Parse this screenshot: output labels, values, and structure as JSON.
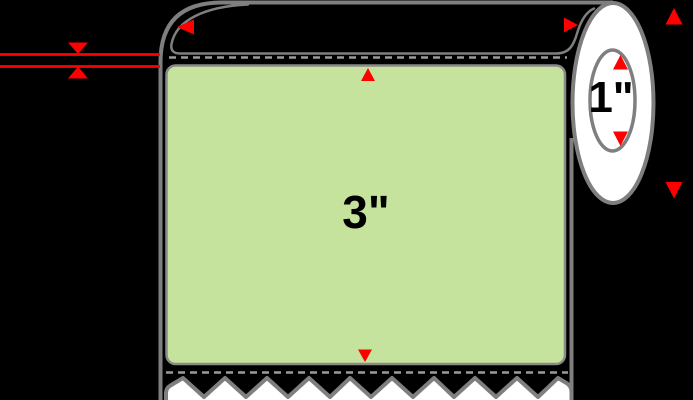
{
  "diagram": {
    "type": "label-roll-product-diagram",
    "description": "Roll of green labels with serrated liner edge, core end view and red dimension arrows",
    "label_face": {
      "dimension_text": "3\""
    },
    "core": {
      "dimension_text": "1\""
    }
  },
  "colors": {
    "background": "#000000",
    "label_fill": "#c5e39c",
    "label_stroke": "#8a8a8a",
    "outline_gray": "#7f7f7f",
    "dash_gray": "#9b9b9b",
    "roll_white": "#ffffff",
    "dimension_red": "#ff0000",
    "dimension_text_color": "#000000"
  }
}
